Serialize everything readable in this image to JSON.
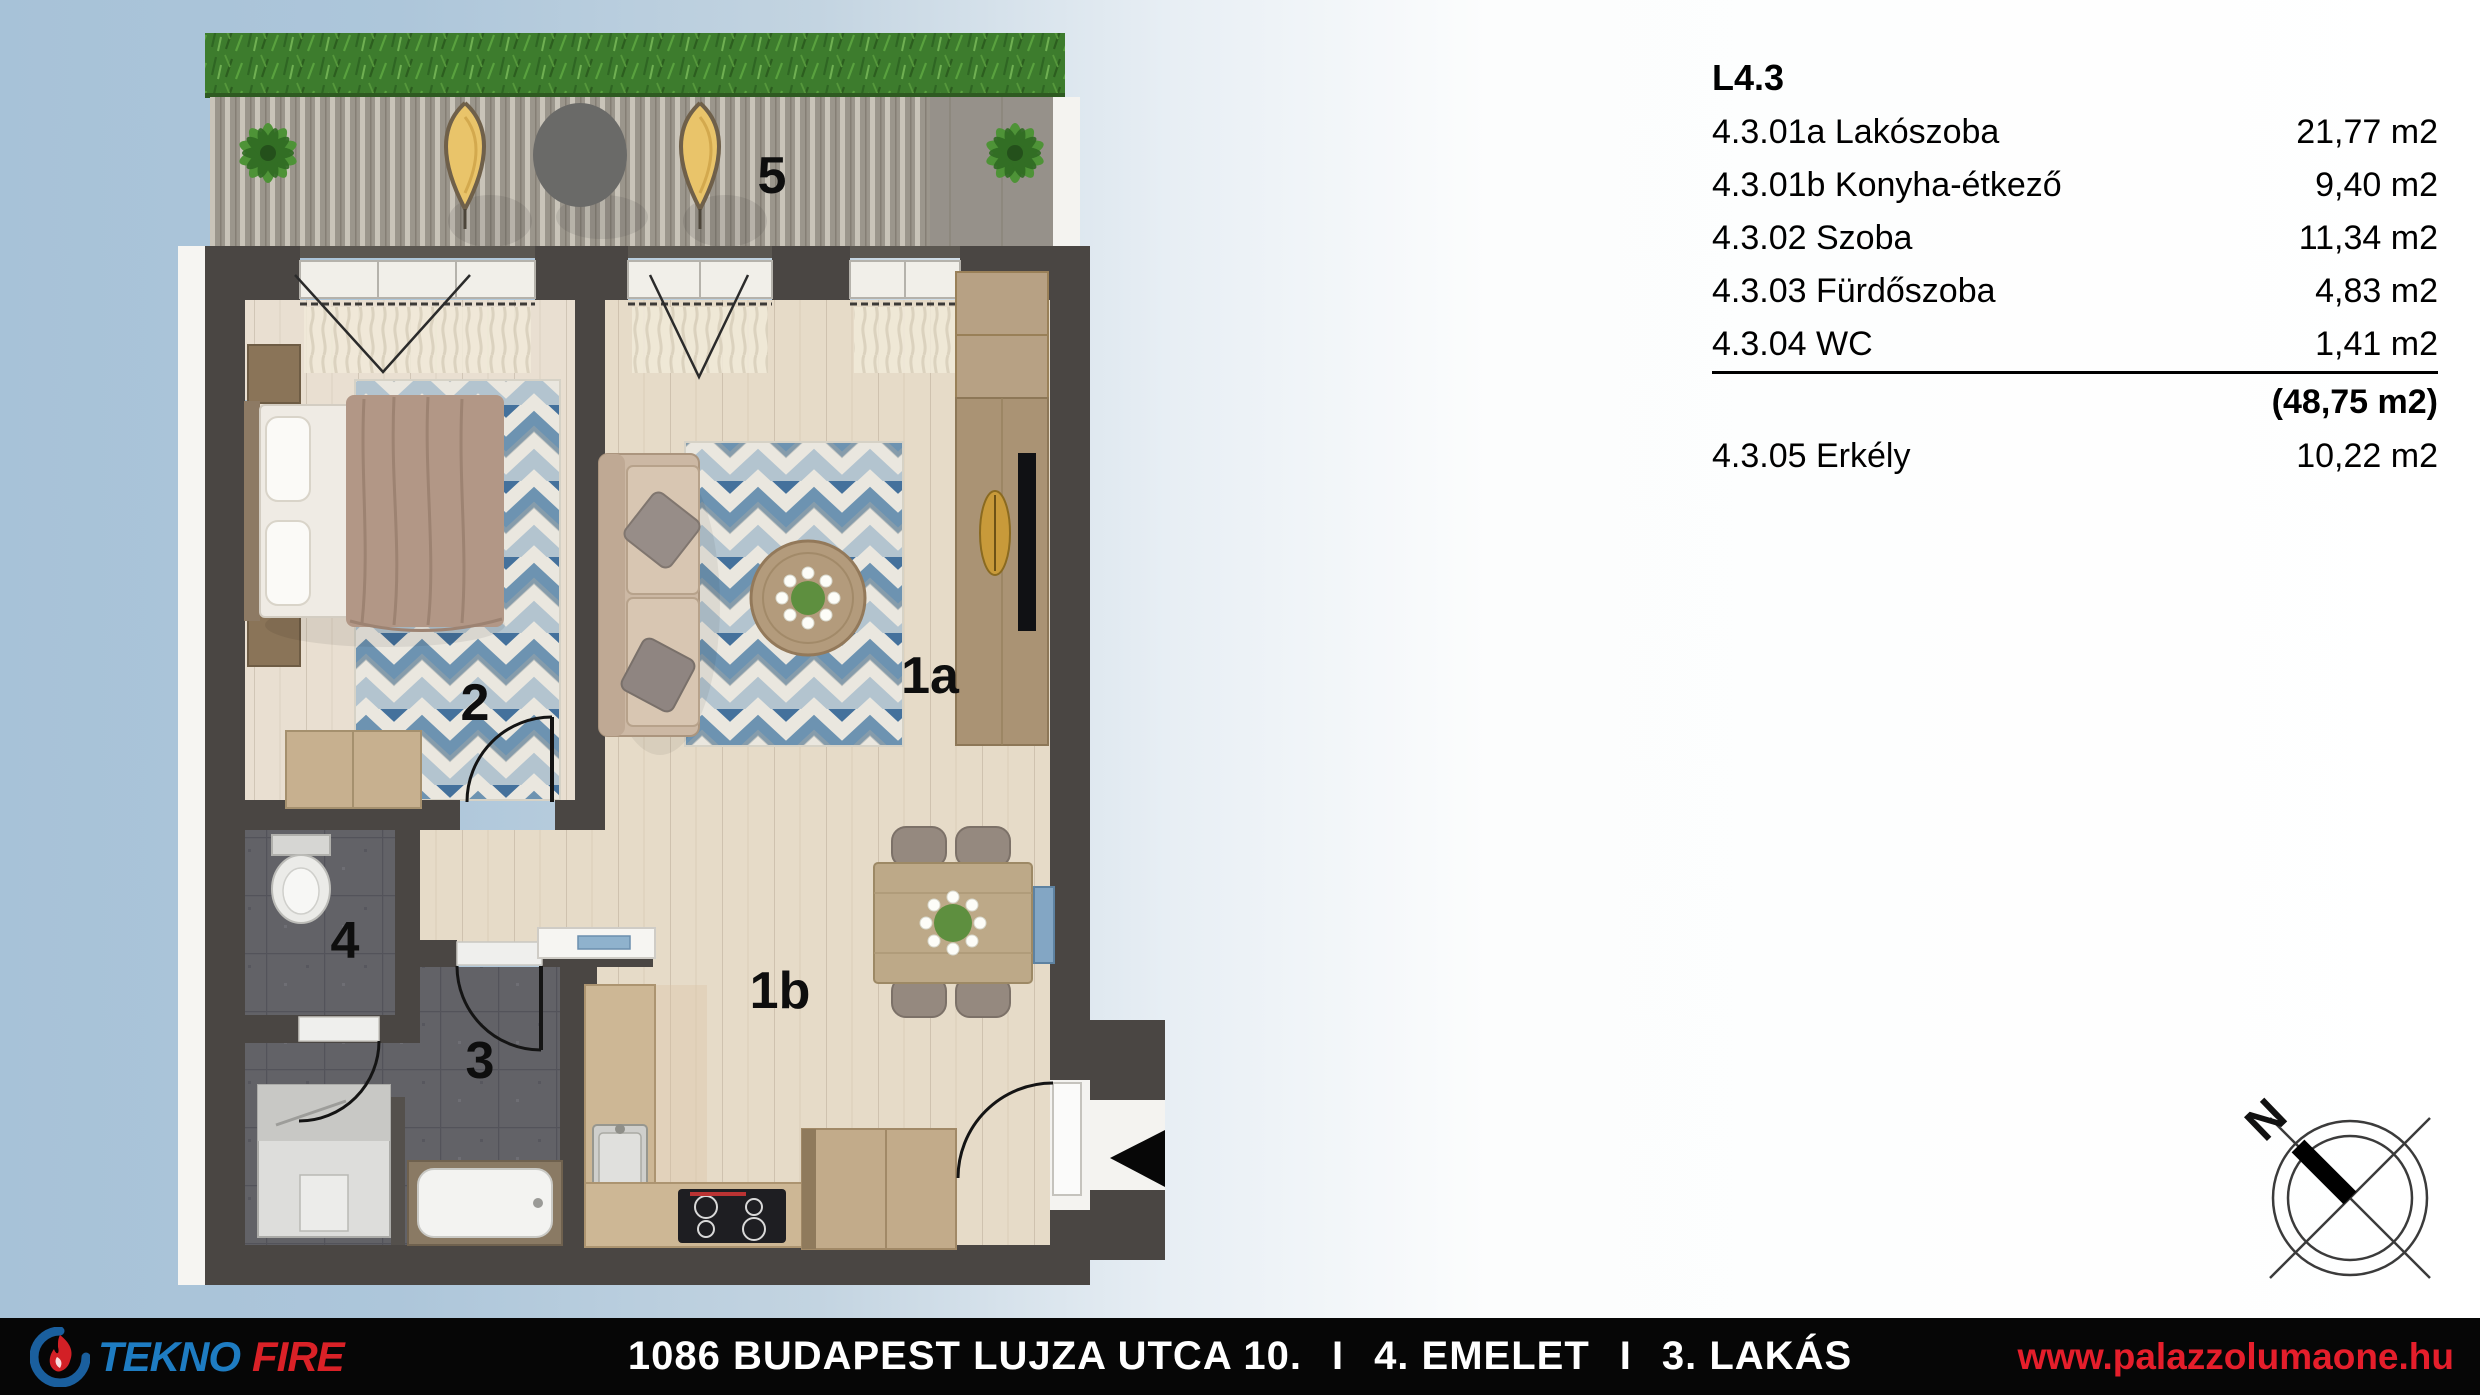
{
  "legend": {
    "title": "L4.3",
    "rows": [
      {
        "label": "4.3.01a Lakószoba",
        "area": "21,77 m2"
      },
      {
        "label": "4.3.01b Konyha-étkező",
        "area": "9,40 m2"
      },
      {
        "label": "4.3.02 Szoba",
        "area": "11,34 m2"
      },
      {
        "label": "4.3.03 Fürdőszoba",
        "area": "4,83 m2"
      },
      {
        "label": "4.3.04 WC",
        "area": "1,41 m2"
      }
    ],
    "total": "(48,75 m2)",
    "balcony": {
      "label": "4.3.05 Erkély",
      "area": "10,22 m2"
    }
  },
  "plan": {
    "labels": {
      "balcony": "5",
      "bedroom": "2",
      "living": "1a",
      "wc": "4",
      "bathroom": "3",
      "kitchen": "1b"
    },
    "compass_n": "N"
  },
  "footer": {
    "brand_first": "TEKNO",
    "brand_second": "FIRE",
    "address": "1086 BUDAPEST LUJZA UTCA 10.",
    "separator": "I",
    "floor": "4. EMELET",
    "apartment": "3. LAKÁS",
    "website": "www.palazzolumaone.hu"
  },
  "colors": {
    "background_blue": "#a7c2d8",
    "wall": "#4a4643",
    "accent_red": "#e51e2b",
    "brand_blue": "#1e7cc2",
    "rug_blue": "#6d93b1",
    "grass_green": "#3d7c2d"
  }
}
